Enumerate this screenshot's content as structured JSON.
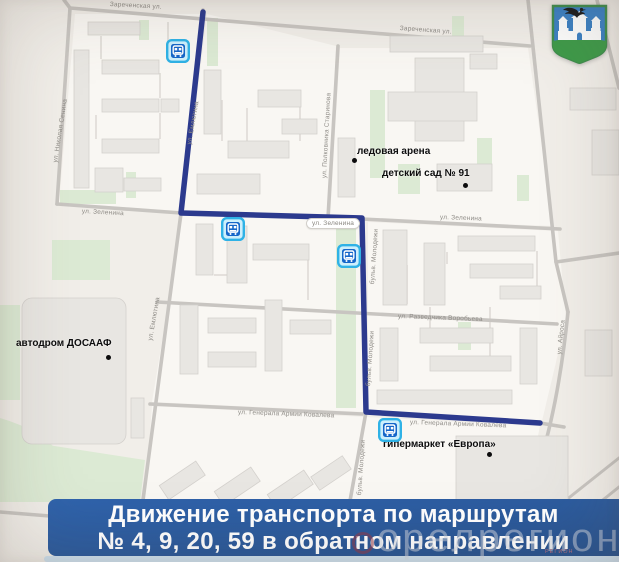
{
  "banner": {
    "line1": "Движение транспорта по маршрутам",
    "line2": "№ 4, 9, 20, 59 в обратном направлении"
  },
  "watermark": {
    "text": "орелрегион",
    "small": "РЕГИОН"
  },
  "icons": {
    "emblem": "oryol-coat-of-arms",
    "bus_stop": "bus-stop-sign"
  },
  "map": {
    "colors": {
      "route": "#2c3a8e",
      "road": "#c8c5c1",
      "banner_bg": "#27528f",
      "bus_border": "#2fb2e6",
      "bus_fill": "#cdeffc",
      "bus_inner": "#1566c9",
      "green": "#dcead4",
      "building": "#e8e6e2"
    },
    "route_points": "203,12 181,213 362,218 366,412 540,423",
    "street_labels": [
      {
        "t": "Зареченская ул.",
        "x": 110,
        "y": 1,
        "r": 3
      },
      {
        "t": "Зареченская ул.",
        "x": 400,
        "y": 25,
        "r": 4
      },
      {
        "t": "ул. Николая Сенина",
        "x": 52,
        "y": 162,
        "r": -81
      },
      {
        "t": "ул. Емлютина",
        "x": 186,
        "y": 144,
        "r": -80
      },
      {
        "t": "ул. Емлютина",
        "x": 147,
        "y": 340,
        "r": -80
      },
      {
        "t": "ул. Полковника Старинова",
        "x": 321,
        "y": 178,
        "r": -87
      },
      {
        "t": "ул. Зеленина",
        "x": 82,
        "y": 208,
        "r": 3
      },
      {
        "t": "ул. Зеленина",
        "x": 306,
        "y": 218,
        "r": 0,
        "pill": true
      },
      {
        "t": "ул. Зеленина",
        "x": 440,
        "y": 214,
        "r": 2
      },
      {
        "t": "бульв. Молодежи",
        "x": 369,
        "y": 284,
        "r": -86
      },
      {
        "t": "бульв. Молодежи",
        "x": 365,
        "y": 386,
        "r": -86
      },
      {
        "t": "бульв. Молодежи",
        "x": 356,
        "y": 495,
        "r": -86
      },
      {
        "t": "ул. Разведчика Воробьева",
        "x": 398,
        "y": 313,
        "r": 2
      },
      {
        "t": "ул. Генерала Армии Ковалева",
        "x": 238,
        "y": 409,
        "r": 2
      },
      {
        "t": "ул. Генерала Армии Ковалева",
        "x": 410,
        "y": 419,
        "r": 2
      },
      {
        "t": "ул. Айроса",
        "x": 556,
        "y": 354,
        "r": -84
      }
    ],
    "pois": [
      {
        "label": "ледовая арена",
        "lx": 357,
        "ly": 146,
        "dx": 352,
        "dy": 158
      },
      {
        "label": "детский сад № 91",
        "lx": 382,
        "ly": 168,
        "dx": 463,
        "dy": 183
      },
      {
        "label": "автодром ДОСААФ",
        "lx": 16,
        "ly": 338,
        "dx": 106,
        "dy": 355
      },
      {
        "label": "гипермаркет «Европа»",
        "lx": 383,
        "ly": 439,
        "dx": 487,
        "dy": 452
      }
    ],
    "bus_stops": [
      {
        "x": 178,
        "y": 51
      },
      {
        "x": 233,
        "y": 229
      },
      {
        "x": 349,
        "y": 256
      },
      {
        "x": 390,
        "y": 430
      }
    ]
  }
}
